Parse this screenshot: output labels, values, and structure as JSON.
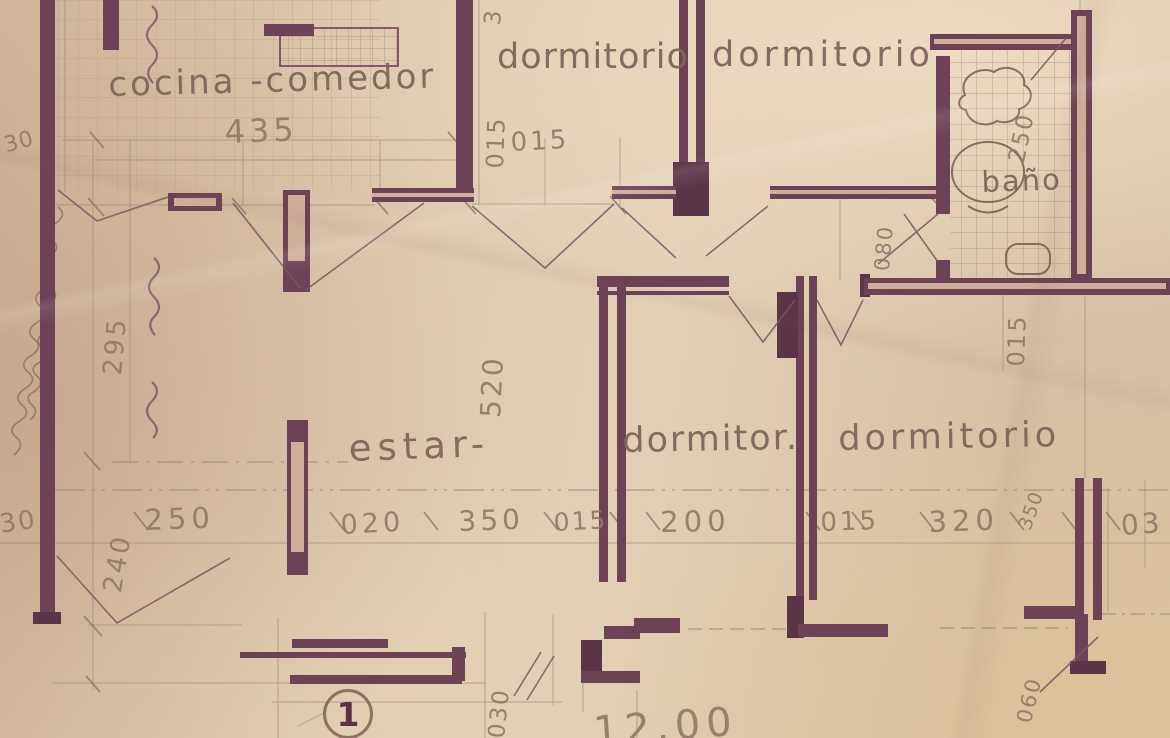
{
  "labels": {
    "cocina_comedor": "cocina -comedor",
    "dim_435": "435",
    "dormitorio_1": "dormitorio",
    "dormitorio_2": "dormitorio",
    "dim_3_top": "3",
    "dim_015_v_top": "015",
    "dim_015_top": "015",
    "bano": "baño",
    "dim_250_bano": "250",
    "dim_080": "080",
    "dim_015_right": "015",
    "dim_520": "520",
    "dim_295": "295",
    "dim_240": "240",
    "estar": "estar-",
    "dormitor": "dormitor.",
    "dormitorio_3": "dormitorio",
    "dim_350_v": "350",
    "dim_30_top": "30",
    "dim_30_bottom": "30",
    "dim_250": "250",
    "dim_020": "020",
    "dim_350": "350",
    "dim_015_a": "015",
    "dim_200": "200",
    "dim_015_b": "015",
    "dim_320": "320",
    "dim_03": "03",
    "dim_060": "060",
    "dim_030": "030",
    "dim_1200": "12.00",
    "detail_1": "1"
  },
  "colors": {
    "paper": "#ddc4a9",
    "wall": "#6d4156",
    "wall_dark": "#5c3447",
    "wall_core": "#cfae9a",
    "pencil": "#a18a77",
    "tile_line": "#b0947e",
    "ink": "#82685c",
    "dim_ink": "#947a69",
    "door_line": "#7a5560"
  }
}
